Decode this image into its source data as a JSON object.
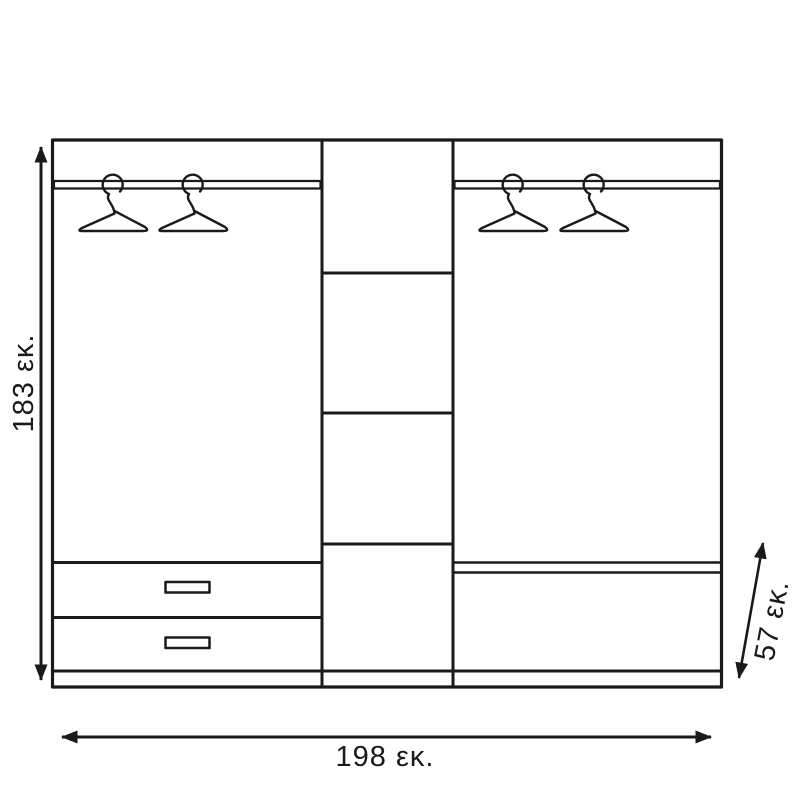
{
  "page": {
    "background": "#ffffff",
    "line_color": "#1a1a1a"
  },
  "diagram": {
    "kind": "wardrobe-front-elevation-drawing",
    "unit": "εκ.",
    "labels": {
      "height": "183 εκ.",
      "width": "198 εκ.",
      "depth": "57 εκ."
    },
    "values": {
      "height_cm": 183,
      "width_cm": 198,
      "depth_cm": 57
    },
    "components": {
      "hangers_left": 2,
      "hangers_right": 2,
      "drawers_left": 2,
      "middle_compartments": 4,
      "right_shelves": 1
    }
  }
}
